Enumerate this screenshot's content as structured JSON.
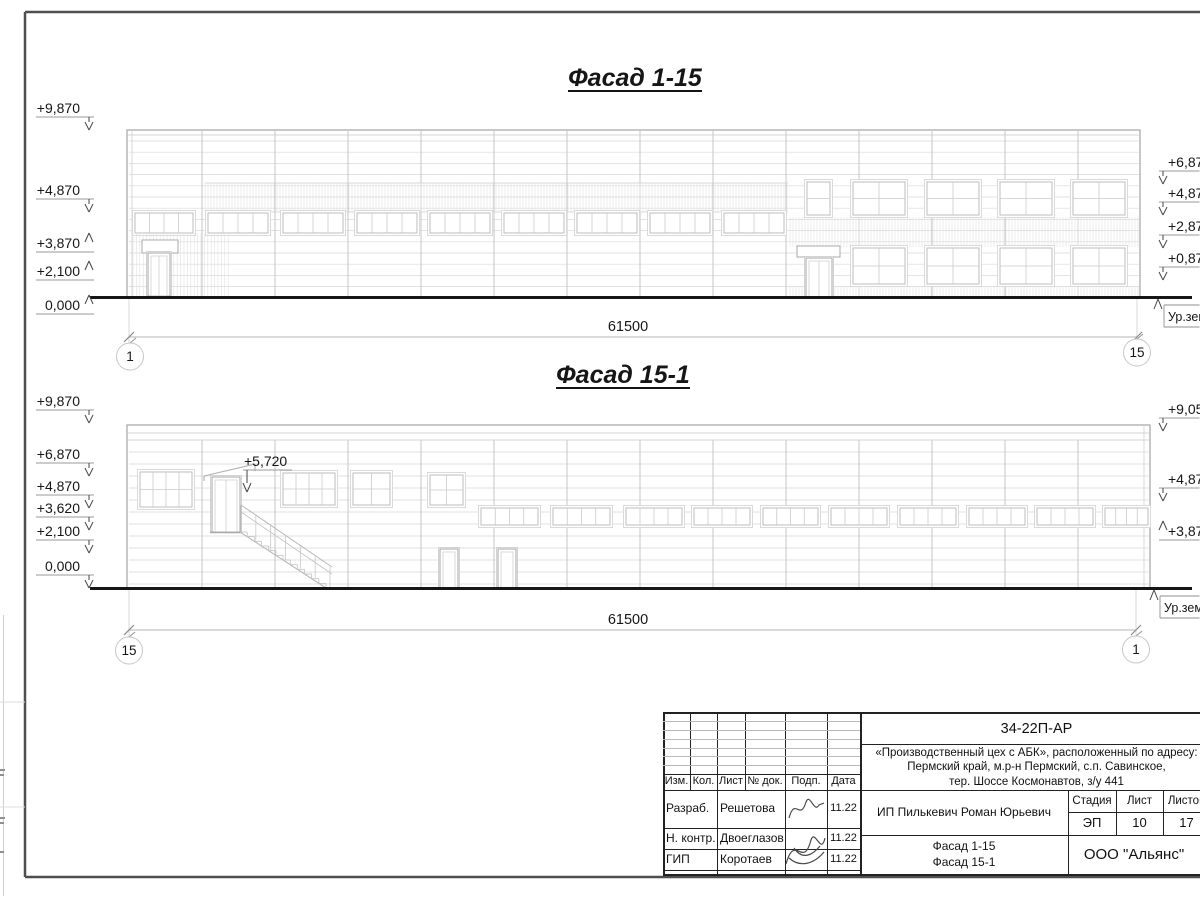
{
  "sheet": {
    "facade1": {
      "title": "Фасад 1-15",
      "dimension_total": "61500",
      "axis_left": "1",
      "axis_right": "15",
      "ground_label": "Ур.земли",
      "left_marks": [
        {
          "label": "+9,870",
          "y": 113,
          "dir": "down"
        },
        {
          "label": "+4,870",
          "y": 195,
          "dir": "down"
        },
        {
          "label": "+3,870",
          "y": 248,
          "dir": "up"
        },
        {
          "label": "+2,100",
          "y": 276,
          "dir": "up"
        },
        {
          "label": "0,000",
          "y": 310,
          "dir": "up"
        }
      ],
      "right_marks": [
        {
          "label": "+6,870",
          "y": 167,
          "dir": "down"
        },
        {
          "label": "+4,870",
          "y": 198,
          "dir": "down"
        },
        {
          "label": "+2,870",
          "y": 231,
          "dir": "down"
        },
        {
          "label": "+0,870",
          "y": 263,
          "dir": "down"
        }
      ]
    },
    "facade2": {
      "title": "Фасад 15-1",
      "dimension_total": "61500",
      "axis_left": "15",
      "axis_right": "1",
      "ground_label": "Ур.земли",
      "stair_mark": "+5,720",
      "left_marks": [
        {
          "label": "+9,870",
          "y": 406,
          "dir": "down"
        },
        {
          "label": "+6,870",
          "y": 459,
          "dir": "down"
        },
        {
          "label": "+4,870",
          "y": 491,
          "dir": "down"
        },
        {
          "label": "+3,620",
          "y": 513,
          "dir": "down"
        },
        {
          "label": "+2,100",
          "y": 536,
          "dir": "down"
        },
        {
          "label": "0,000",
          "y": 571,
          "dir": "down"
        }
      ],
      "right_marks": [
        {
          "label": "+9,050",
          "y": 414,
          "dir": "down"
        },
        {
          "label": "+4,870",
          "y": 484,
          "dir": "down"
        },
        {
          "label": "+3,870",
          "y": 536,
          "dir": "up"
        }
      ]
    }
  },
  "title_block": {
    "doc_number": "34-22П-АР",
    "project_name_line1": "«Производственный цех с АБК», расположенный по адресу:",
    "project_name_line2": "Пермский край, м.р-н Пермский, с.п. Савинское,",
    "project_name_line3": "тер. Шоссе Космонавтов, з/у 441",
    "col_headers": {
      "izm": "Изм.",
      "kol": "Кол.",
      "list": "Лист",
      "doc": "№ док.",
      "podp": "Подп.",
      "data": "Дата"
    },
    "rows": [
      {
        "role": "Разраб.",
        "name": "Решетова",
        "date": "11.22"
      },
      {
        "role": "Н. контр.",
        "name": "Двоеглазов",
        "date": "11.22"
      },
      {
        "role": "ГИП",
        "name": "Коротаев",
        "date": "11.22"
      }
    ],
    "client": "ИП Пилькевич Роман Юрьевич",
    "stage_label": "Стадия",
    "sheet_label": "Лист",
    "sheets_label": "Листов",
    "stage": "ЭП",
    "sheet_number": "10",
    "sheets_total": "17",
    "drawing_title_line1": "Фасад 1-15",
    "drawing_title_line2": "Фасад 15-1",
    "company": "ООО \"Альянс\""
  }
}
